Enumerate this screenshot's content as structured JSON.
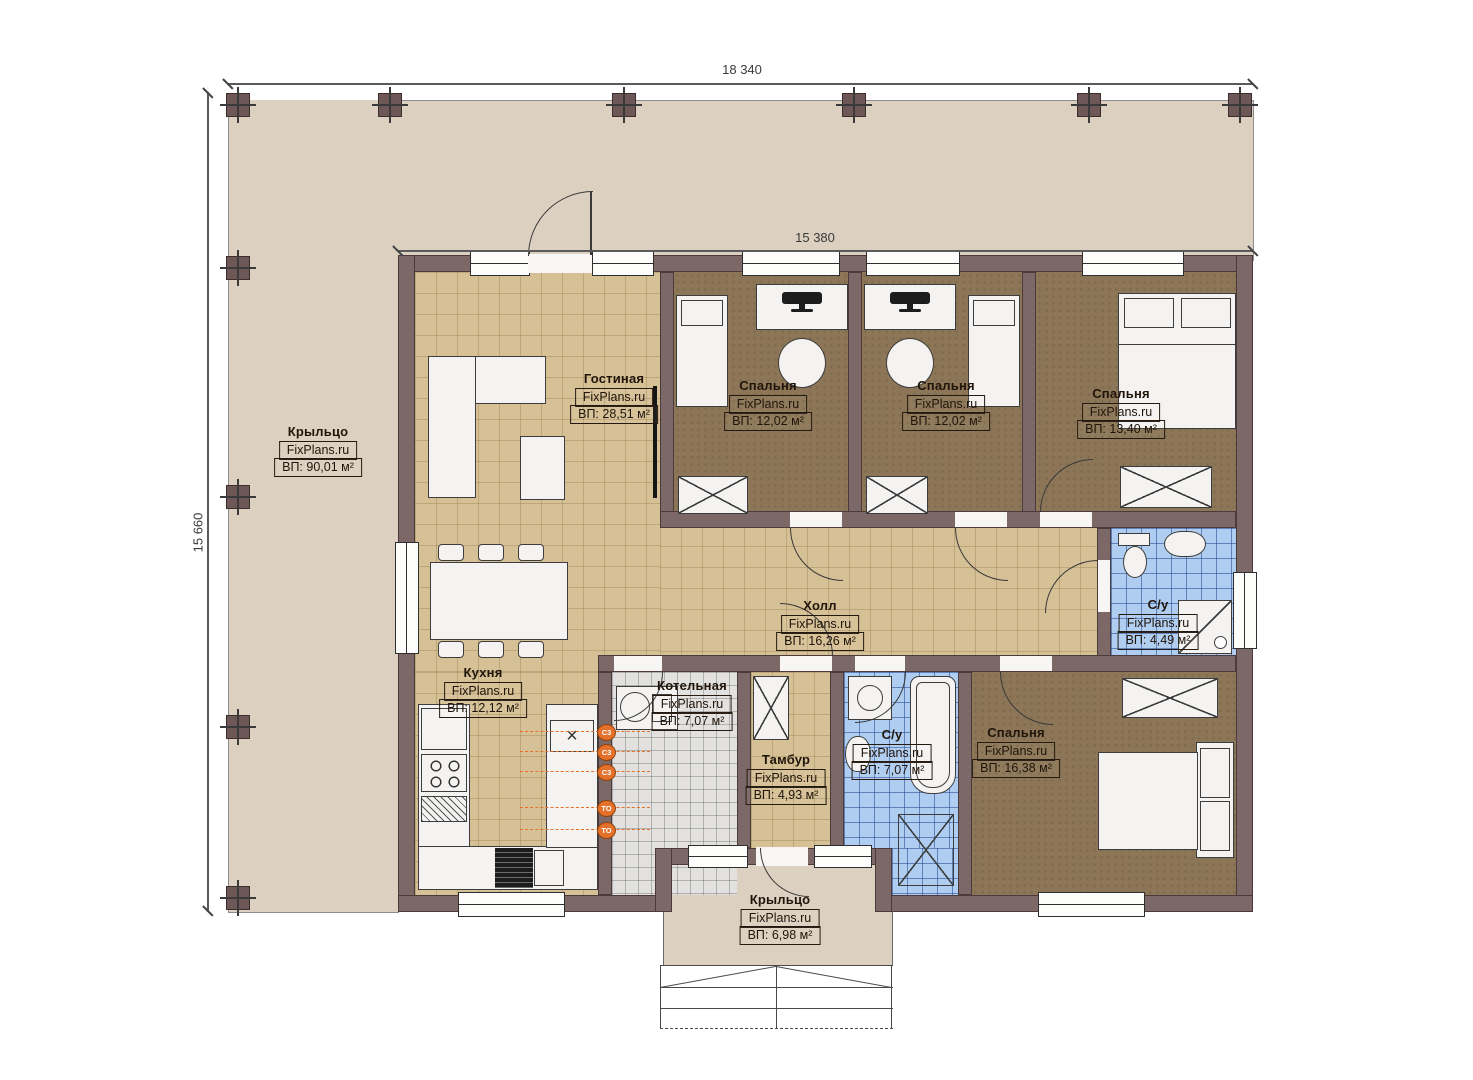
{
  "plan_title": "Single-storey house floor plan",
  "brand": "FixPlans.ru",
  "dimensions": {
    "top": "18 340",
    "inner_top": "15 380",
    "left": "15 660"
  },
  "rooms": [
    {
      "id": "porch-left",
      "name": "Крыльцо",
      "area": "ВП: 90,01 м²"
    },
    {
      "id": "living-room",
      "name": "Гостиная",
      "area": "ВП: 28,51 м²"
    },
    {
      "id": "bedroom-1",
      "name": "Спальня",
      "area": "ВП: 12,02 м²"
    },
    {
      "id": "bedroom-2",
      "name": "Спальня",
      "area": "ВП: 12,02 м²"
    },
    {
      "id": "bedroom-3",
      "name": "Спальня",
      "area": "ВП: 13,40 м²"
    },
    {
      "id": "hall",
      "name": "Холл",
      "area": "ВП: 16,26 м²"
    },
    {
      "id": "bathroom-small",
      "name": "С/у",
      "area": "ВП: 4,49 м²"
    },
    {
      "id": "kitchen",
      "name": "Кухня",
      "area": "ВП: 12,12 м²"
    },
    {
      "id": "boiler-room",
      "name": "Котельная",
      "area": "ВП: 7,07 м²"
    },
    {
      "id": "vestibule",
      "name": "Тамбур",
      "area": "ВП: 4,93 м²"
    },
    {
      "id": "bathroom-big",
      "name": "С/у",
      "area": "ВП: 7,07 м²"
    },
    {
      "id": "bedroom-4",
      "name": "Спальня",
      "area": "ВП: 16,38 м²"
    },
    {
      "id": "porch-bottom",
      "name": "Крыльцо",
      "area": "ВП: 6,98 м²"
    }
  ],
  "equipment_tags": [
    "С3",
    "С3",
    "С3",
    "ТО",
    "ТО"
  ],
  "colors": {
    "wall": "#7b6867",
    "porch_floor": "#dcd1c0",
    "tile_floor": "#d6c095",
    "carpet_floor": "#8d7657",
    "bathroom_floor": "#aecdf0",
    "boiler_floor": "#e2e1df",
    "equipment_accent": "#e4702a"
  }
}
